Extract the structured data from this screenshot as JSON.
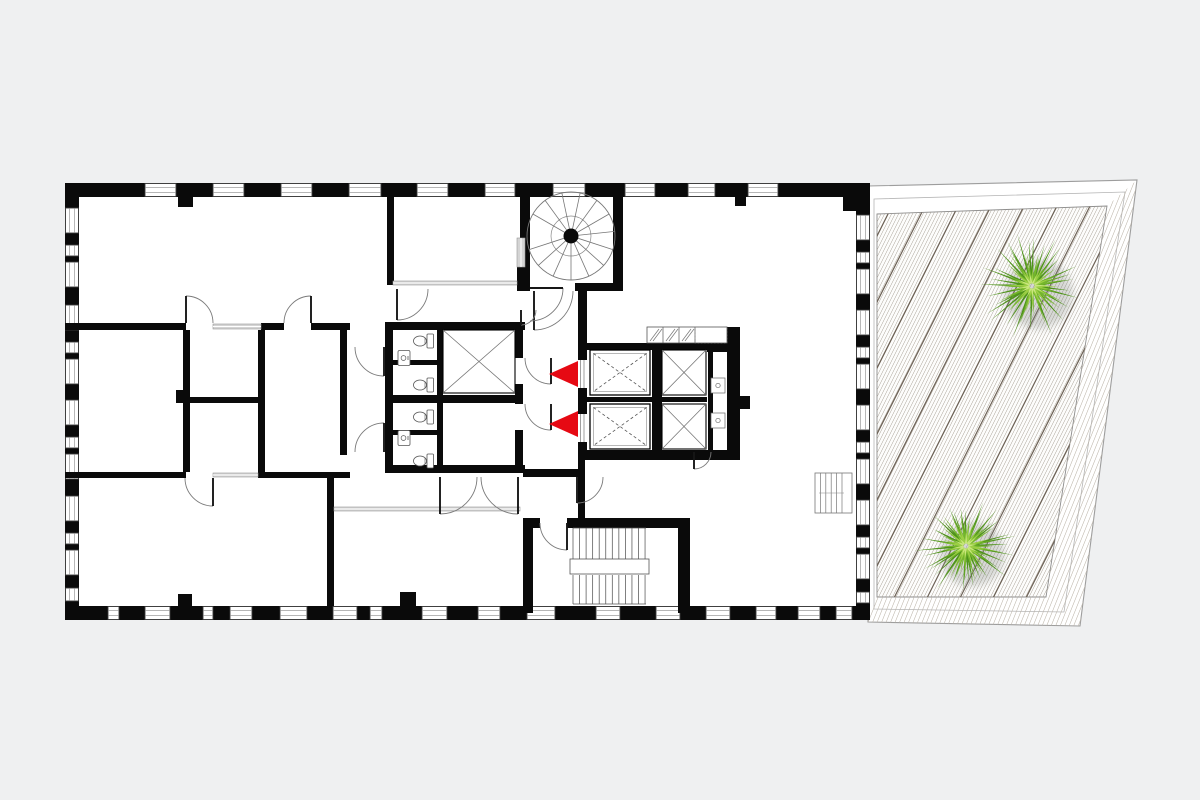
{
  "title": "architectural-floor-plan",
  "scene": {
    "bg": "#eff0f1",
    "floor": "#ffffff",
    "wall": "#0a0a0a",
    "line": "#555555",
    "thin": "#8a8a8a",
    "window_stroke": "#3a3a3a",
    "glass_fill": "#d4d4d4",
    "glass_stroke": "#969696",
    "accent_red": "#e60913",
    "deck_board": "#6b6054",
    "deck_fine": "#a59c90",
    "band_fine": "#bdb5aa",
    "terrace_edge": "#9d9d9d",
    "plant_dark": "#4f941b",
    "plant_mid": "#74b62c",
    "plant_light": "#9ccf45",
    "plant_pale": "#c9e67e",
    "plant_shadow": "#7d837d"
  },
  "building": {
    "x": 65,
    "y": 183,
    "w": 805,
    "h": 437,
    "wall_t": 14
  },
  "perimeter_windows": {
    "top": [
      [
        145,
        31
      ],
      [
        213,
        31
      ],
      [
        281,
        31
      ],
      [
        349,
        32
      ],
      [
        417,
        31
      ],
      [
        485,
        30
      ],
      [
        553,
        32
      ],
      [
        625,
        30
      ],
      [
        688,
        27
      ],
      [
        748,
        30
      ]
    ],
    "bottom": [
      [
        108,
        11
      ],
      [
        145,
        25
      ],
      [
        203,
        10
      ],
      [
        230,
        22
      ],
      [
        280,
        27
      ],
      [
        333,
        24
      ],
      [
        370,
        12
      ],
      [
        422,
        25
      ],
      [
        478,
        22
      ],
      [
        527,
        28
      ],
      [
        596,
        24
      ],
      [
        656,
        24
      ],
      [
        706,
        24
      ],
      [
        756,
        20
      ],
      [
        798,
        22
      ],
      [
        836,
        16
      ]
    ],
    "left": [
      [
        208,
        25
      ],
      [
        245,
        11
      ],
      [
        262,
        25
      ],
      [
        305,
        25
      ],
      [
        342,
        11
      ],
      [
        359,
        25
      ],
      [
        400,
        25
      ],
      [
        437,
        11
      ],
      [
        454,
        25
      ],
      [
        496,
        25
      ],
      [
        533,
        11
      ],
      [
        550,
        25
      ],
      [
        588,
        13
      ]
    ],
    "right": [
      [
        215,
        25
      ],
      [
        252,
        11
      ],
      [
        269,
        25
      ],
      [
        310,
        25
      ],
      [
        347,
        11
      ],
      [
        364,
        25
      ],
      [
        405,
        25
      ],
      [
        442,
        11
      ],
      [
        459,
        25
      ],
      [
        500,
        25
      ],
      [
        537,
        11
      ],
      [
        554,
        25
      ],
      [
        592,
        11
      ]
    ]
  },
  "interior_walls": [
    [
      65,
      323,
      121,
      7
    ],
    [
      261,
      323,
      23,
      7
    ],
    [
      311,
      323,
      39,
      7
    ],
    [
      387,
      197,
      7,
      88
    ],
    [
      183,
      330,
      7,
      142
    ],
    [
      183,
      397,
      82,
      6
    ],
    [
      258,
      330,
      7,
      142
    ],
    [
      340,
      330,
      7,
      125
    ],
    [
      65,
      472,
      121,
      6
    ],
    [
      258,
      472,
      92,
      6
    ],
    [
      327,
      477,
      7,
      129
    ],
    [
      520,
      183,
      10,
      108
    ],
    [
      613,
      183,
      10,
      100
    ],
    [
      575,
      283,
      48,
      8
    ],
    [
      385,
      322,
      140,
      8
    ],
    [
      385,
      322,
      8,
      151
    ],
    [
      437,
      330,
      6,
      135
    ],
    [
      385,
      395,
      138,
      8
    ],
    [
      385,
      360,
      52,
      5
    ],
    [
      385,
      430,
      52,
      5
    ],
    [
      515,
      322,
      8,
      36
    ],
    [
      515,
      384,
      8,
      20
    ],
    [
      515,
      430,
      8,
      43
    ],
    [
      385,
      465,
      140,
      8
    ],
    [
      517,
      267,
      8,
      24
    ],
    [
      523,
      469,
      62,
      8
    ],
    [
      578,
      460,
      7,
      60
    ],
    [
      578,
      288,
      9,
      172
    ],
    [
      587,
      343,
      120,
      7
    ],
    [
      652,
      343,
      10,
      117
    ],
    [
      578,
      450,
      150,
      10
    ],
    [
      708,
      352,
      5,
      100
    ],
    [
      727,
      327,
      13,
      133
    ],
    [
      707,
      343,
      20,
      9
    ],
    [
      585,
      397,
      122,
      5
    ],
    [
      523,
      518,
      17,
      10
    ],
    [
      567,
      518,
      123,
      10
    ],
    [
      523,
      518,
      10,
      95
    ],
    [
      678,
      518,
      12,
      95
    ]
  ],
  "pillars": [
    [
      178,
      197,
      15,
      10
    ],
    [
      735,
      197,
      11,
      9
    ],
    [
      843,
      197,
      27,
      14
    ],
    [
      176,
      390,
      14,
      13
    ],
    [
      178,
      594,
      14,
      12
    ],
    [
      400,
      592,
      16,
      14
    ],
    [
      737,
      396,
      13,
      13
    ]
  ],
  "glass_bars": [
    [
      213,
      324,
      48,
      5
    ],
    [
      213,
      473,
      45,
      4
    ],
    [
      334,
      507,
      186,
      4
    ],
    [
      393,
      281,
      124,
      4
    ],
    [
      517,
      238,
      8,
      29
    ]
  ],
  "doors": [
    {
      "x": 186,
      "y": 323,
      "r": 27,
      "leaf": 270,
      "end": 0,
      "sweep": 1
    },
    {
      "x": 311,
      "y": 323,
      "r": 27,
      "leaf": 270,
      "end": 180,
      "sweep": 0
    },
    {
      "x": 397,
      "y": 289,
      "r": 31,
      "leaf": 90,
      "end": 0,
      "sweep": 0
    },
    {
      "x": 534,
      "y": 291,
      "r": 39,
      "leaf": 90,
      "end": 0,
      "sweep": 0
    },
    {
      "x": 530,
      "y": 288,
      "r": 33,
      "leaf": 0,
      "end": 90,
      "sweep": 1
    },
    {
      "x": 551,
      "y": 358,
      "r": 26,
      "leaf": 90,
      "end": 180,
      "sweep": 1
    },
    {
      "x": 551,
      "y": 404,
      "r": 26,
      "leaf": 90,
      "end": 180,
      "sweep": 1
    },
    {
      "x": 440,
      "y": 477,
      "r": 37,
      "leaf": 90,
      "end": 0,
      "sweep": 0
    },
    {
      "x": 518,
      "y": 477,
      "r": 37,
      "leaf": 90,
      "end": 180,
      "sweep": 1
    },
    {
      "x": 577,
      "y": 477,
      "r": 26,
      "leaf": 90,
      "end": 0,
      "sweep": 0
    },
    {
      "x": 213,
      "y": 478,
      "r": 28,
      "leaf": 90,
      "end": 180,
      "sweep": 1
    },
    {
      "x": 694,
      "y": 452,
      "r": 17,
      "leaf": 90,
      "end": 0,
      "sweep": 0
    },
    {
      "x": 567,
      "y": 523,
      "r": 27,
      "leaf": 90,
      "end": 180,
      "sweep": 1
    },
    {
      "x": 384,
      "y": 347,
      "r": 29,
      "leaf": 90,
      "end": 180,
      "sweep": 1
    },
    {
      "x": 384,
      "y": 452,
      "r": 29,
      "leaf": 270,
      "end": 180,
      "sweep": 0
    },
    {
      "x": 521,
      "y": 310,
      "r": 15,
      "leaf": 90,
      "end": 0,
      "sweep": 0
    }
  ],
  "entrance_arrows": {
    "color": "#e60913",
    "items": [
      {
        "tip_x": 549,
        "tip_y": 374,
        "w": 29,
        "h": 26
      },
      {
        "tip_x": 549,
        "tip_y": 424,
        "w": 29,
        "h": 26
      }
    ]
  },
  "elevator_core": {
    "cars": [
      [
        590,
        350,
        60,
        45
      ],
      [
        590,
        404,
        60,
        45
      ]
    ],
    "door_sills": [
      [
        578,
        360,
        9,
        28
      ],
      [
        578,
        414,
        9,
        28
      ]
    ],
    "shafts": [
      [
        662,
        350,
        44,
        45
      ],
      [
        662,
        404,
        44,
        45
      ]
    ],
    "x_rooms": [
      [
        443,
        330,
        72,
        63
      ]
    ],
    "kitchen_counter": {
      "rect": [
        647,
        327,
        80,
        16
      ],
      "cells": [
        647,
        663,
        679
      ],
      "cell_w": 16,
      "dotted": [
        695,
        327,
        32,
        16
      ]
    },
    "kitchen_sinks": [
      [
        711,
        378,
        14,
        15
      ],
      [
        711,
        413,
        14,
        15
      ]
    ]
  },
  "wc": {
    "toilets": [
      [
        424,
        341
      ],
      [
        424,
        385
      ],
      [
        424,
        417
      ],
      [
        424,
        461
      ]
    ],
    "sinks": [
      [
        404,
        358
      ],
      [
        404,
        438
      ]
    ]
  },
  "spiral_stair": {
    "cx": 571,
    "cy": 236,
    "r_outer": 44,
    "r_inner": 20,
    "hub_r": 7.5,
    "spokes": 14,
    "start_angle": -150,
    "step": 24
  },
  "main_stair": {
    "x": 573,
    "y": 528,
    "w": 73,
    "run1_y2": 559,
    "run2_y1": 575,
    "y2": 604,
    "tread_step": 6.55,
    "landing": [
      570,
      559,
      79,
      15
    ]
  },
  "side_steps": {
    "x": 815,
    "y": 473,
    "w": 37,
    "h": 40,
    "treads": 5
  },
  "terrace": {
    "outer": [
      [
        868,
        186
      ],
      [
        1137,
        180
      ],
      [
        1080,
        626
      ],
      [
        868,
        622
      ]
    ],
    "mid": [
      [
        874,
        199
      ],
      [
        1125,
        192
      ],
      [
        1064,
        612
      ],
      [
        874,
        609
      ]
    ],
    "deck": [
      [
        877,
        214
      ],
      [
        1107,
        206
      ],
      [
        1046,
        597
      ],
      [
        877,
        597
      ]
    ],
    "band_right": [
      [
        1107,
        206
      ],
      [
        1137,
        180
      ],
      [
        1080,
        626
      ],
      [
        1046,
        597
      ]
    ],
    "band_bottom": [
      [
        877,
        597
      ],
      [
        1046,
        597
      ],
      [
        1080,
        626
      ],
      [
        868,
        622
      ]
    ],
    "deck_slope": 2.0,
    "board_step": 33,
    "fine_step": 3.5,
    "plants": [
      {
        "cx": 1032,
        "cy": 286,
        "r": 46
      },
      {
        "cx": 966,
        "cy": 546,
        "r": 43
      }
    ]
  }
}
